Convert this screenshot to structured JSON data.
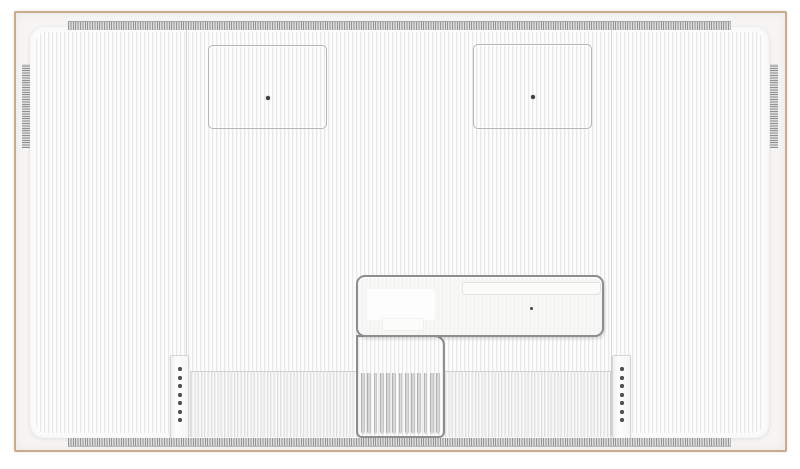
{
  "meta": {
    "description": "Rear view of a slim frame-style television: white vertically-ribbed back panel inside a thin tan frame, two VESA mount squares, central recessed connection compartment with heatsink fins, two screw-hole rails and comb vent strips on all edges.",
    "visible_text": ""
  },
  "colors": {
    "frame_tan": "#c9ab8e",
    "frame_inner": "#f6f5f3",
    "panel_white": "#fcfcfc",
    "stripe_gray": "#e9e9e9",
    "vent_gray": "#949494",
    "seam_gray": "#d6d6d6",
    "outline_gray": "#8e8e8e",
    "square_outline": "#b6b6b6",
    "dot_dark": "#3f3f3f"
  },
  "back_panel": {
    "texture": "fine vertical ribbing",
    "vesa_mounts": {
      "count": 2,
      "screw_holes_each": 1
    },
    "rails": {
      "count": 2,
      "screw_holes_each": 7
    },
    "heatsink": {
      "fin_count": 13
    },
    "vents": {
      "top": "comb strip",
      "bottom": "comb strip",
      "left": "comb strip",
      "right": "comb strip"
    },
    "recess": {
      "has_info_label": true,
      "screw_holes": 1
    }
  }
}
